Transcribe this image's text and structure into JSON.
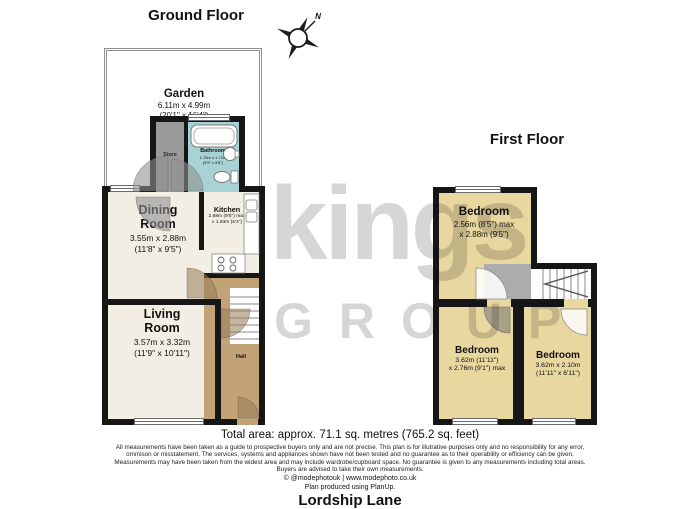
{
  "floors": {
    "ground": {
      "title": "Ground Floor"
    },
    "first": {
      "title": "First Floor"
    }
  },
  "compass": {
    "north_label": "N"
  },
  "watermark": {
    "line1": "kings",
    "line2": "GROUP"
  },
  "rooms": {
    "garden": {
      "name": "Garden",
      "dims_m": "6.11m x 4.99m",
      "dims_ft": "(20'1\" x 16'4\")"
    },
    "store": {
      "name": "Store"
    },
    "bathroom": {
      "name": "Bathroom",
      "dims_m": "1.75m x 1.72m",
      "dims_ft": "(5'9\" x 5'8\")"
    },
    "dining": {
      "name_line1": "Dining",
      "name_line2": "Room",
      "dims_m": "3.55m x 2.88m",
      "dims_ft": "(11'8\" x 9'5\")"
    },
    "kitchen": {
      "name": "Kitchen",
      "dims_line1": "2.88m (9'5\") max",
      "dims_line2": "x 1.93m (6'4\")"
    },
    "living": {
      "name_line1": "Living",
      "name_line2": "Room",
      "dims_m": "3.57m x 3.32m",
      "dims_ft": "(11'9\" x 10'11\")"
    },
    "hall": {
      "name": "Hall"
    },
    "bedroom_first_top": {
      "name": "Bedroom",
      "dims_line1": "2.56m (8'5\") max",
      "dims_line2": "x 2.88m (9'5\")"
    },
    "bedroom_first_left": {
      "name": "Bedroom",
      "dims_line1": "3.62m (11'11\")",
      "dims_line2": "x 2.76m (9'1\") max"
    },
    "bedroom_first_right": {
      "name": "Bedroom",
      "dims_line1": "3.62m x 2.10m",
      "dims_line2": "(11'11\" x 6'11\")"
    }
  },
  "summary": {
    "total_area": "Total area: approx. 71.1 sq. metres (765.2 sq. feet)"
  },
  "disclaimer": {
    "line1": "All measurements have been taken as a guide to prospective buyers only and are not precise. This plan is for illutrative purposes only and no responsibility for any error,",
    "line2": "ommison or misstatement. The services, systems and appliances shown have not been tested and no guarantee as to their operability or efficiency can be given.",
    "line3": "Measurements may have been taken from the widest area and may include wardrobe/cupboard space. No guarantee is given to any measurements including total areas.",
    "line4": "Buyers are advised to take their own measurements."
  },
  "footer": {
    "credit": "© @modephotouk | www.modephoto.co.uk",
    "produced": "Plan produced using PlanUp.",
    "address": "Lordship Lane"
  },
  "colors": {
    "wall": "#161616",
    "room-cream": "#f2eee3",
    "room-tan": "#e9d7a0",
    "hall-brown": "#c2a377",
    "bath-teal": "#a9d2d4",
    "store-gray": "#9a9a9a",
    "landing-gray": "#acacac",
    "watermark-gray": "#d6d6d6",
    "fence-gray": "#8f8f8f"
  }
}
